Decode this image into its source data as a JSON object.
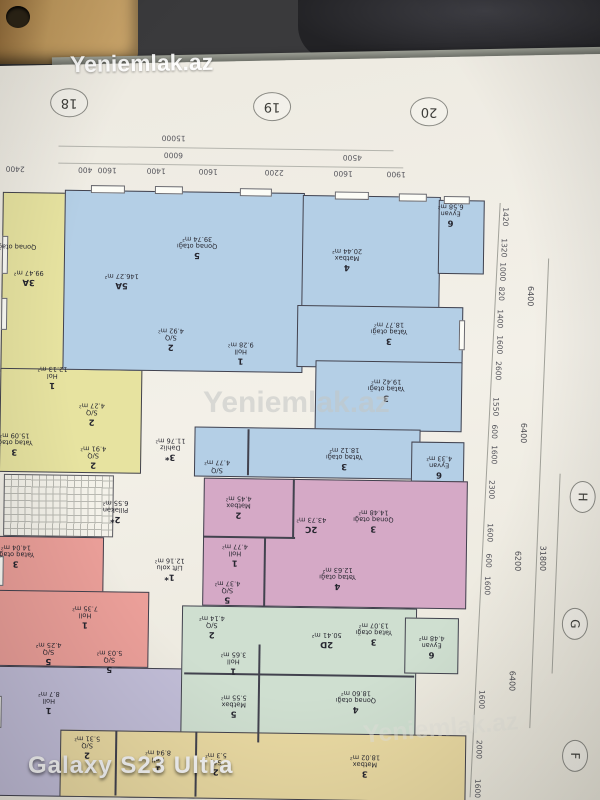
{
  "photo": {
    "site_watermark": "Yeniemlak.az",
    "device_watermark": "Galaxy S23 Ultra"
  },
  "plan": {
    "grid_top": [
      "18",
      "19",
      "20"
    ],
    "grid_right": [
      "H",
      "G",
      "F"
    ],
    "dim_top_totals": [
      "15000",
      "6000",
      "4500"
    ],
    "dim_top_chain": [
      "2400",
      "400",
      "1600",
      "1400",
      "1600",
      "2200",
      "1600",
      "1900"
    ],
    "dim_right_chain": [
      "1420",
      "1320",
      "1000",
      "820",
      "1400",
      "1600",
      "2600",
      "1550",
      "600",
      "1600",
      "2300",
      "1600",
      "600",
      "1600",
      "1600",
      "2000",
      "1600"
    ],
    "dim_right_totals": [
      "6400",
      "6400",
      "6200",
      "6400"
    ],
    "dim_right_grand": "31800",
    "rooms": [
      {
        "no": "5",
        "name": "Qonaq otağı",
        "area": "39.74 m²"
      },
      {
        "no": "5A",
        "name": "",
        "area": "146.27 m²"
      },
      {
        "no": "2",
        "name": "S/Q",
        "area": "4.92 m²"
      },
      {
        "no": "1",
        "name": "Holl",
        "area": "9.28 m²"
      },
      {
        "no": "4",
        "name": "Mətbəx",
        "area": "20.44 m²"
      },
      {
        "no": "6",
        "name": "Eyvan",
        "area": "6.58 m²"
      },
      {
        "no": "3",
        "name": "Yataq otağı",
        "area": "18.77 m²"
      },
      {
        "no": "3",
        "name": "Yataq otağı",
        "area": "19.42 m²"
      },
      {
        "no": "3",
        "name": "Yataq otağı",
        "area": "18.12 m²"
      },
      {
        "no": "6",
        "name": "Eyvan",
        "area": "4.33 m²"
      },
      {
        "no": "",
        "name": "S/Q",
        "area": "4.77 m²"
      },
      {
        "no": "",
        "name": "Qonaq otağı",
        "area": ""
      },
      {
        "no": "3A",
        "name": "",
        "area": "99.47 m²"
      },
      {
        "no": "1",
        "name": "Hol",
        "area": "12.13 m²"
      },
      {
        "no": "2",
        "name": "S/Q",
        "area": "4.27 m²"
      },
      {
        "no": "2",
        "name": "S/Q",
        "area": "4.91 m²"
      },
      {
        "no": "3",
        "name": "Yataq otağı",
        "area": "15.09 m²"
      },
      {
        "no": "3*",
        "name": "Dəhliz",
        "area": "11.76 m²"
      },
      {
        "no": "2*",
        "name": "Pilləkən",
        "area": "6.55 m²"
      },
      {
        "no": "1*",
        "name": "Lift xolu",
        "area": "12.16 m²"
      },
      {
        "no": "2",
        "name": "Mətbəx",
        "area": "4.45 m²"
      },
      {
        "no": "2C",
        "name": "",
        "area": "43.73 m²"
      },
      {
        "no": "3",
        "name": "Qonaq otağı",
        "area": "14.48 m²"
      },
      {
        "no": "1",
        "name": "Holl",
        "area": "4.77 m²"
      },
      {
        "no": "5",
        "name": "S/Q",
        "area": "4.37 m²"
      },
      {
        "no": "4",
        "name": "Yataq otağı",
        "area": "12.63 m²"
      },
      {
        "no": "3",
        "name": "Yataq otağı",
        "area": "14.04 m²"
      },
      {
        "no": "1",
        "name": "Holl",
        "area": "7.35 m²"
      },
      {
        "no": "5",
        "name": "S/Q",
        "area": "4.25 m²"
      },
      {
        "no": "5",
        "name": "S/Q",
        "area": "5.03 m²"
      },
      {
        "no": "1",
        "name": "Holl",
        "area": "8.7 m²"
      },
      {
        "no": "2",
        "name": "S/Q",
        "area": "4.14 m²"
      },
      {
        "no": "2D",
        "name": "",
        "area": "50.41 m²"
      },
      {
        "no": "3",
        "name": "Yataq otağı",
        "area": "13.07 m²"
      },
      {
        "no": "1",
        "name": "Holl",
        "area": "3.65 m²"
      },
      {
        "no": "5",
        "name": "Mətbəx",
        "area": "5.55 m²"
      },
      {
        "no": "4",
        "name": "Qonaq otağı",
        "area": "18.60 m²"
      },
      {
        "no": "6",
        "name": "Eyvan",
        "area": "4.48 m²"
      },
      {
        "no": "2",
        "name": "S/Q",
        "area": "5.31 m²"
      },
      {
        "no": "1",
        "name": "Holl",
        "area": "8.94 m²"
      },
      {
        "no": "2",
        "name": "S/Q",
        "area": "5.3 m²"
      },
      {
        "no": "3",
        "name": "Mətbəx",
        "area": "18.02 m²"
      }
    ]
  },
  "colors": {
    "blue": "#b4cfe6",
    "yellow": "#e7e3a0",
    "pink": "#d5a9c6",
    "red": "#eb9f99",
    "purple": "#c1bdd7",
    "green": "#cfdfd0",
    "tan": "#e9d9a2"
  }
}
